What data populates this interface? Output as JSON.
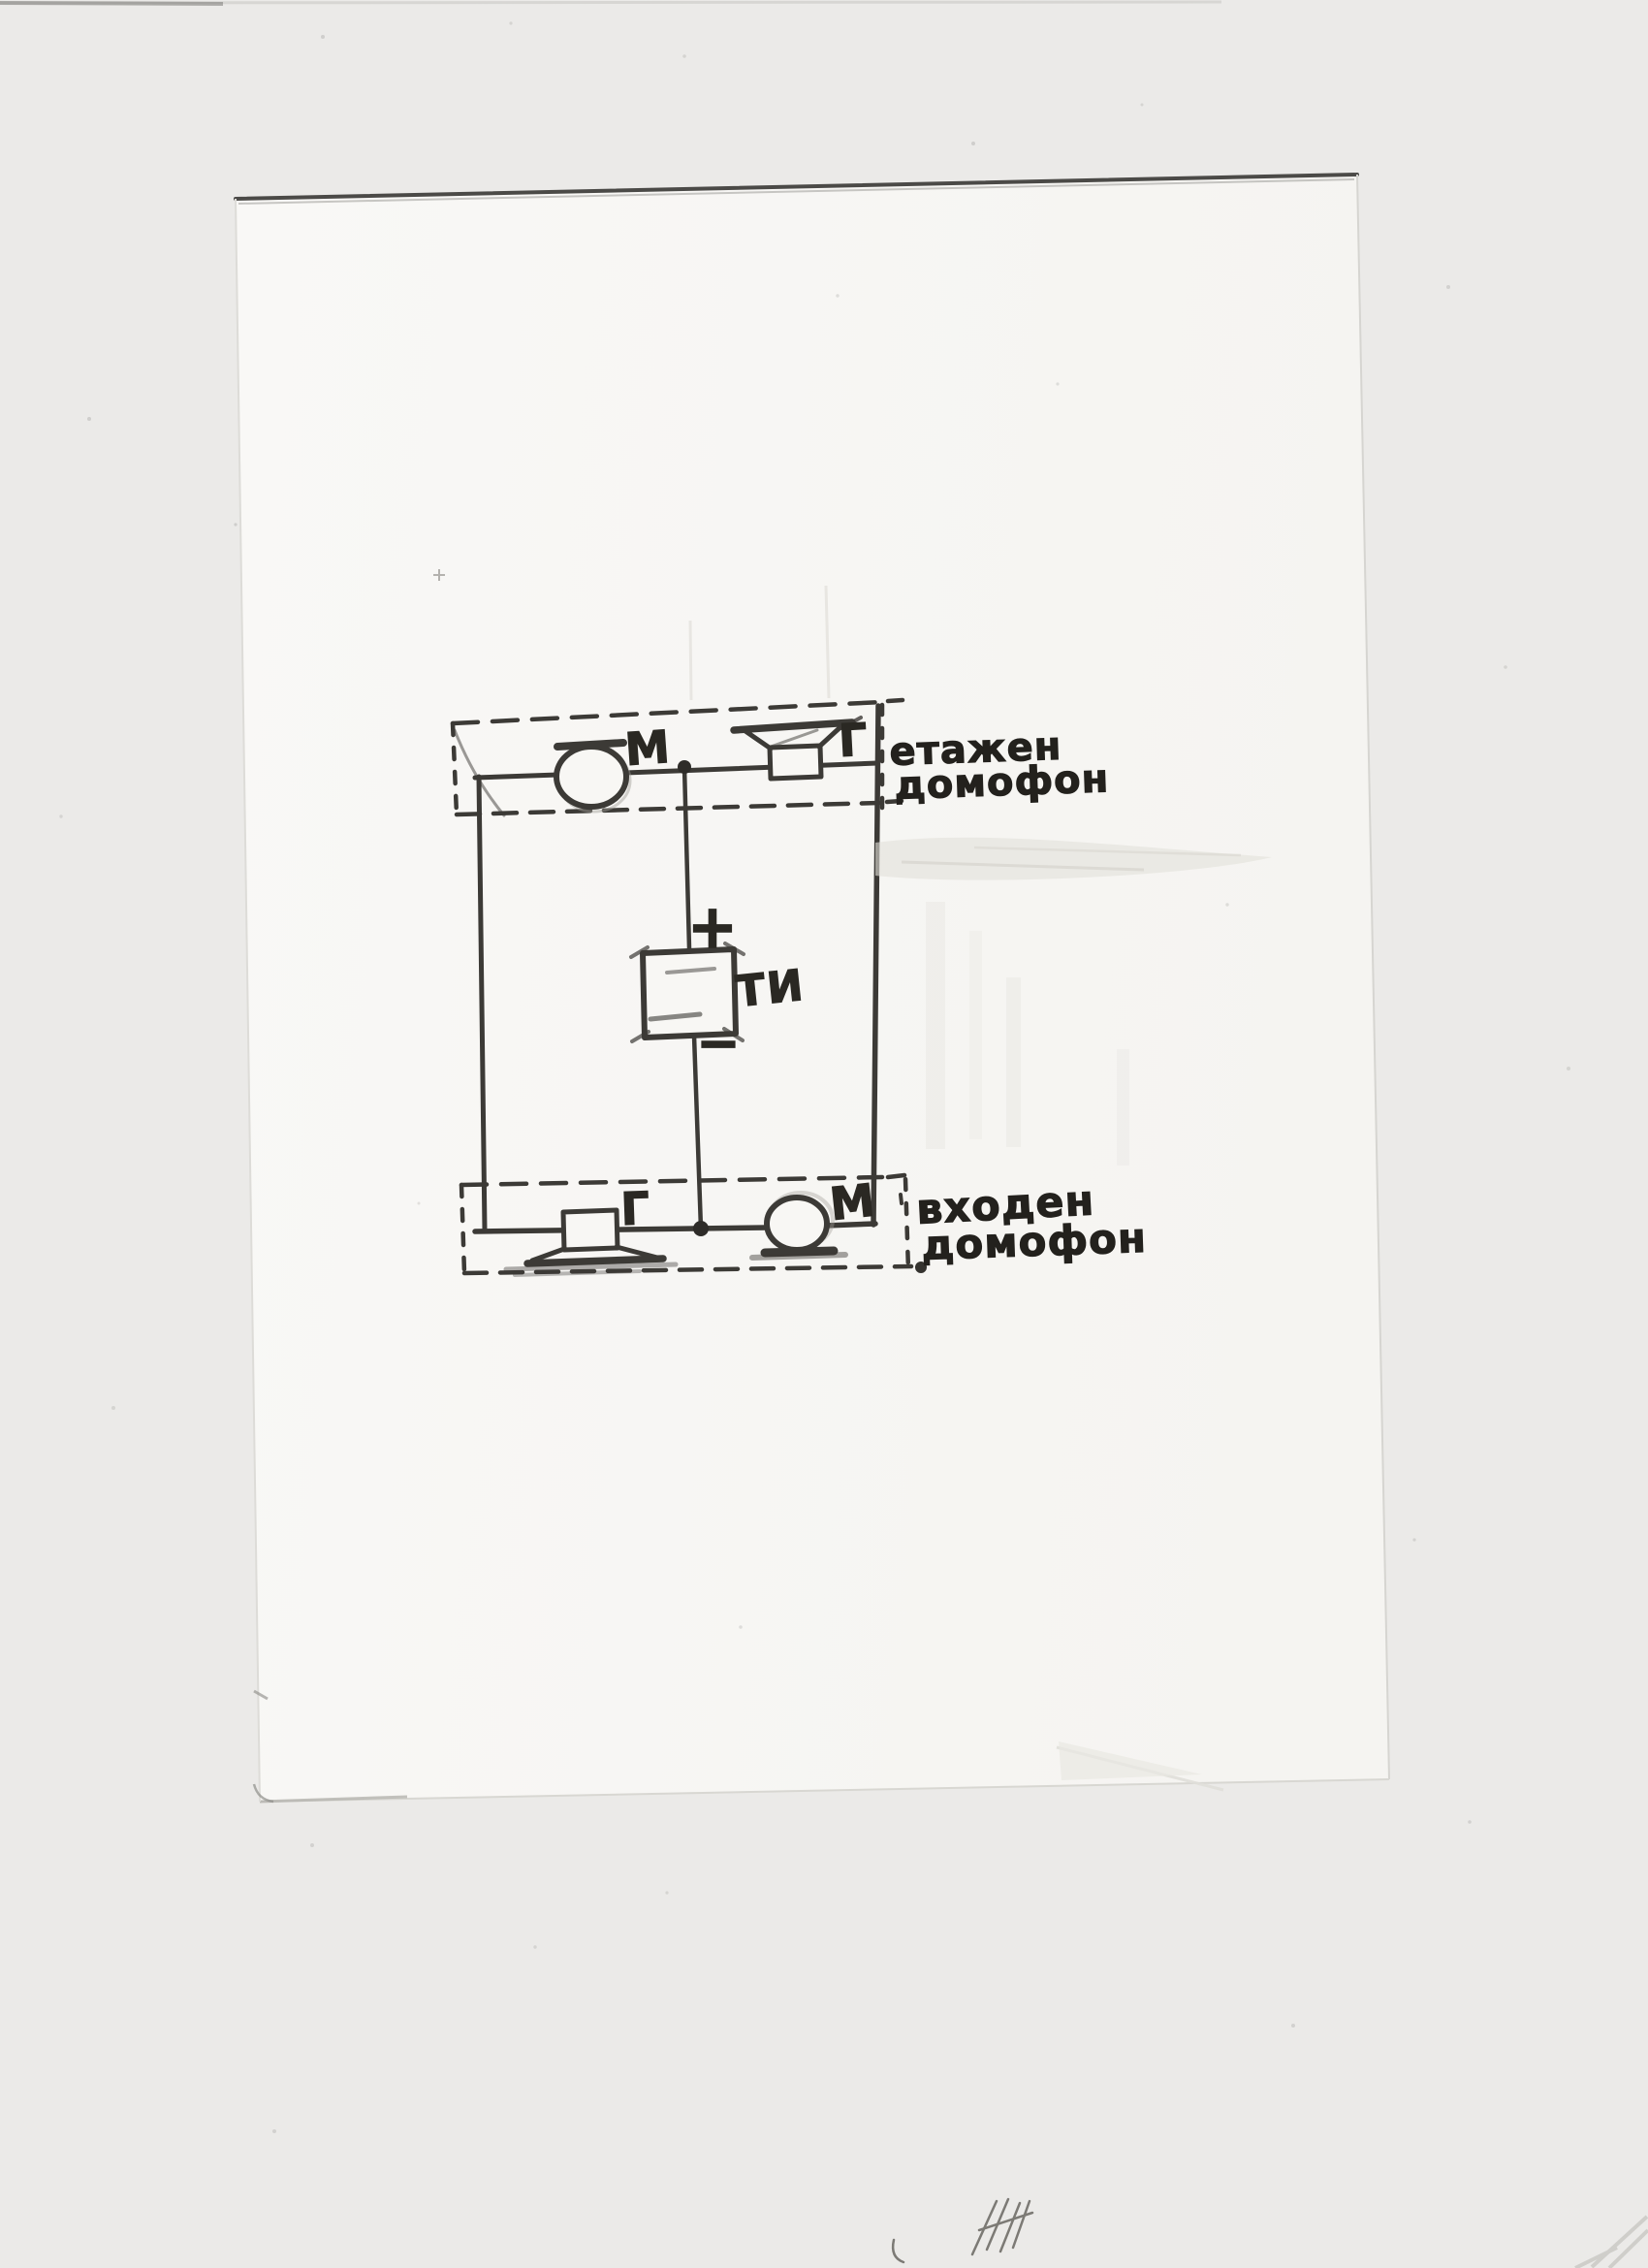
{
  "scan": {
    "background_color": "#ebeae8",
    "paper_color": "#f8f7f4",
    "pencil_color": "#3c3a36",
    "ink_color": "#23211d"
  },
  "diagram": {
    "type": "hand-drawn intercom wiring schematic",
    "top_unit": {
      "label_line1": "етажен",
      "label_line2": "домофон",
      "microphone_label": "М",
      "speaker_label": "Г"
    },
    "bottom_unit": {
      "label_line1": "входен",
      "label_line2": "домофон",
      "microphone_label": "М",
      "speaker_label": "Г"
    },
    "power_supply": {
      "label": "ТИ",
      "plus_label": "+",
      "minus_label": "−"
    }
  }
}
